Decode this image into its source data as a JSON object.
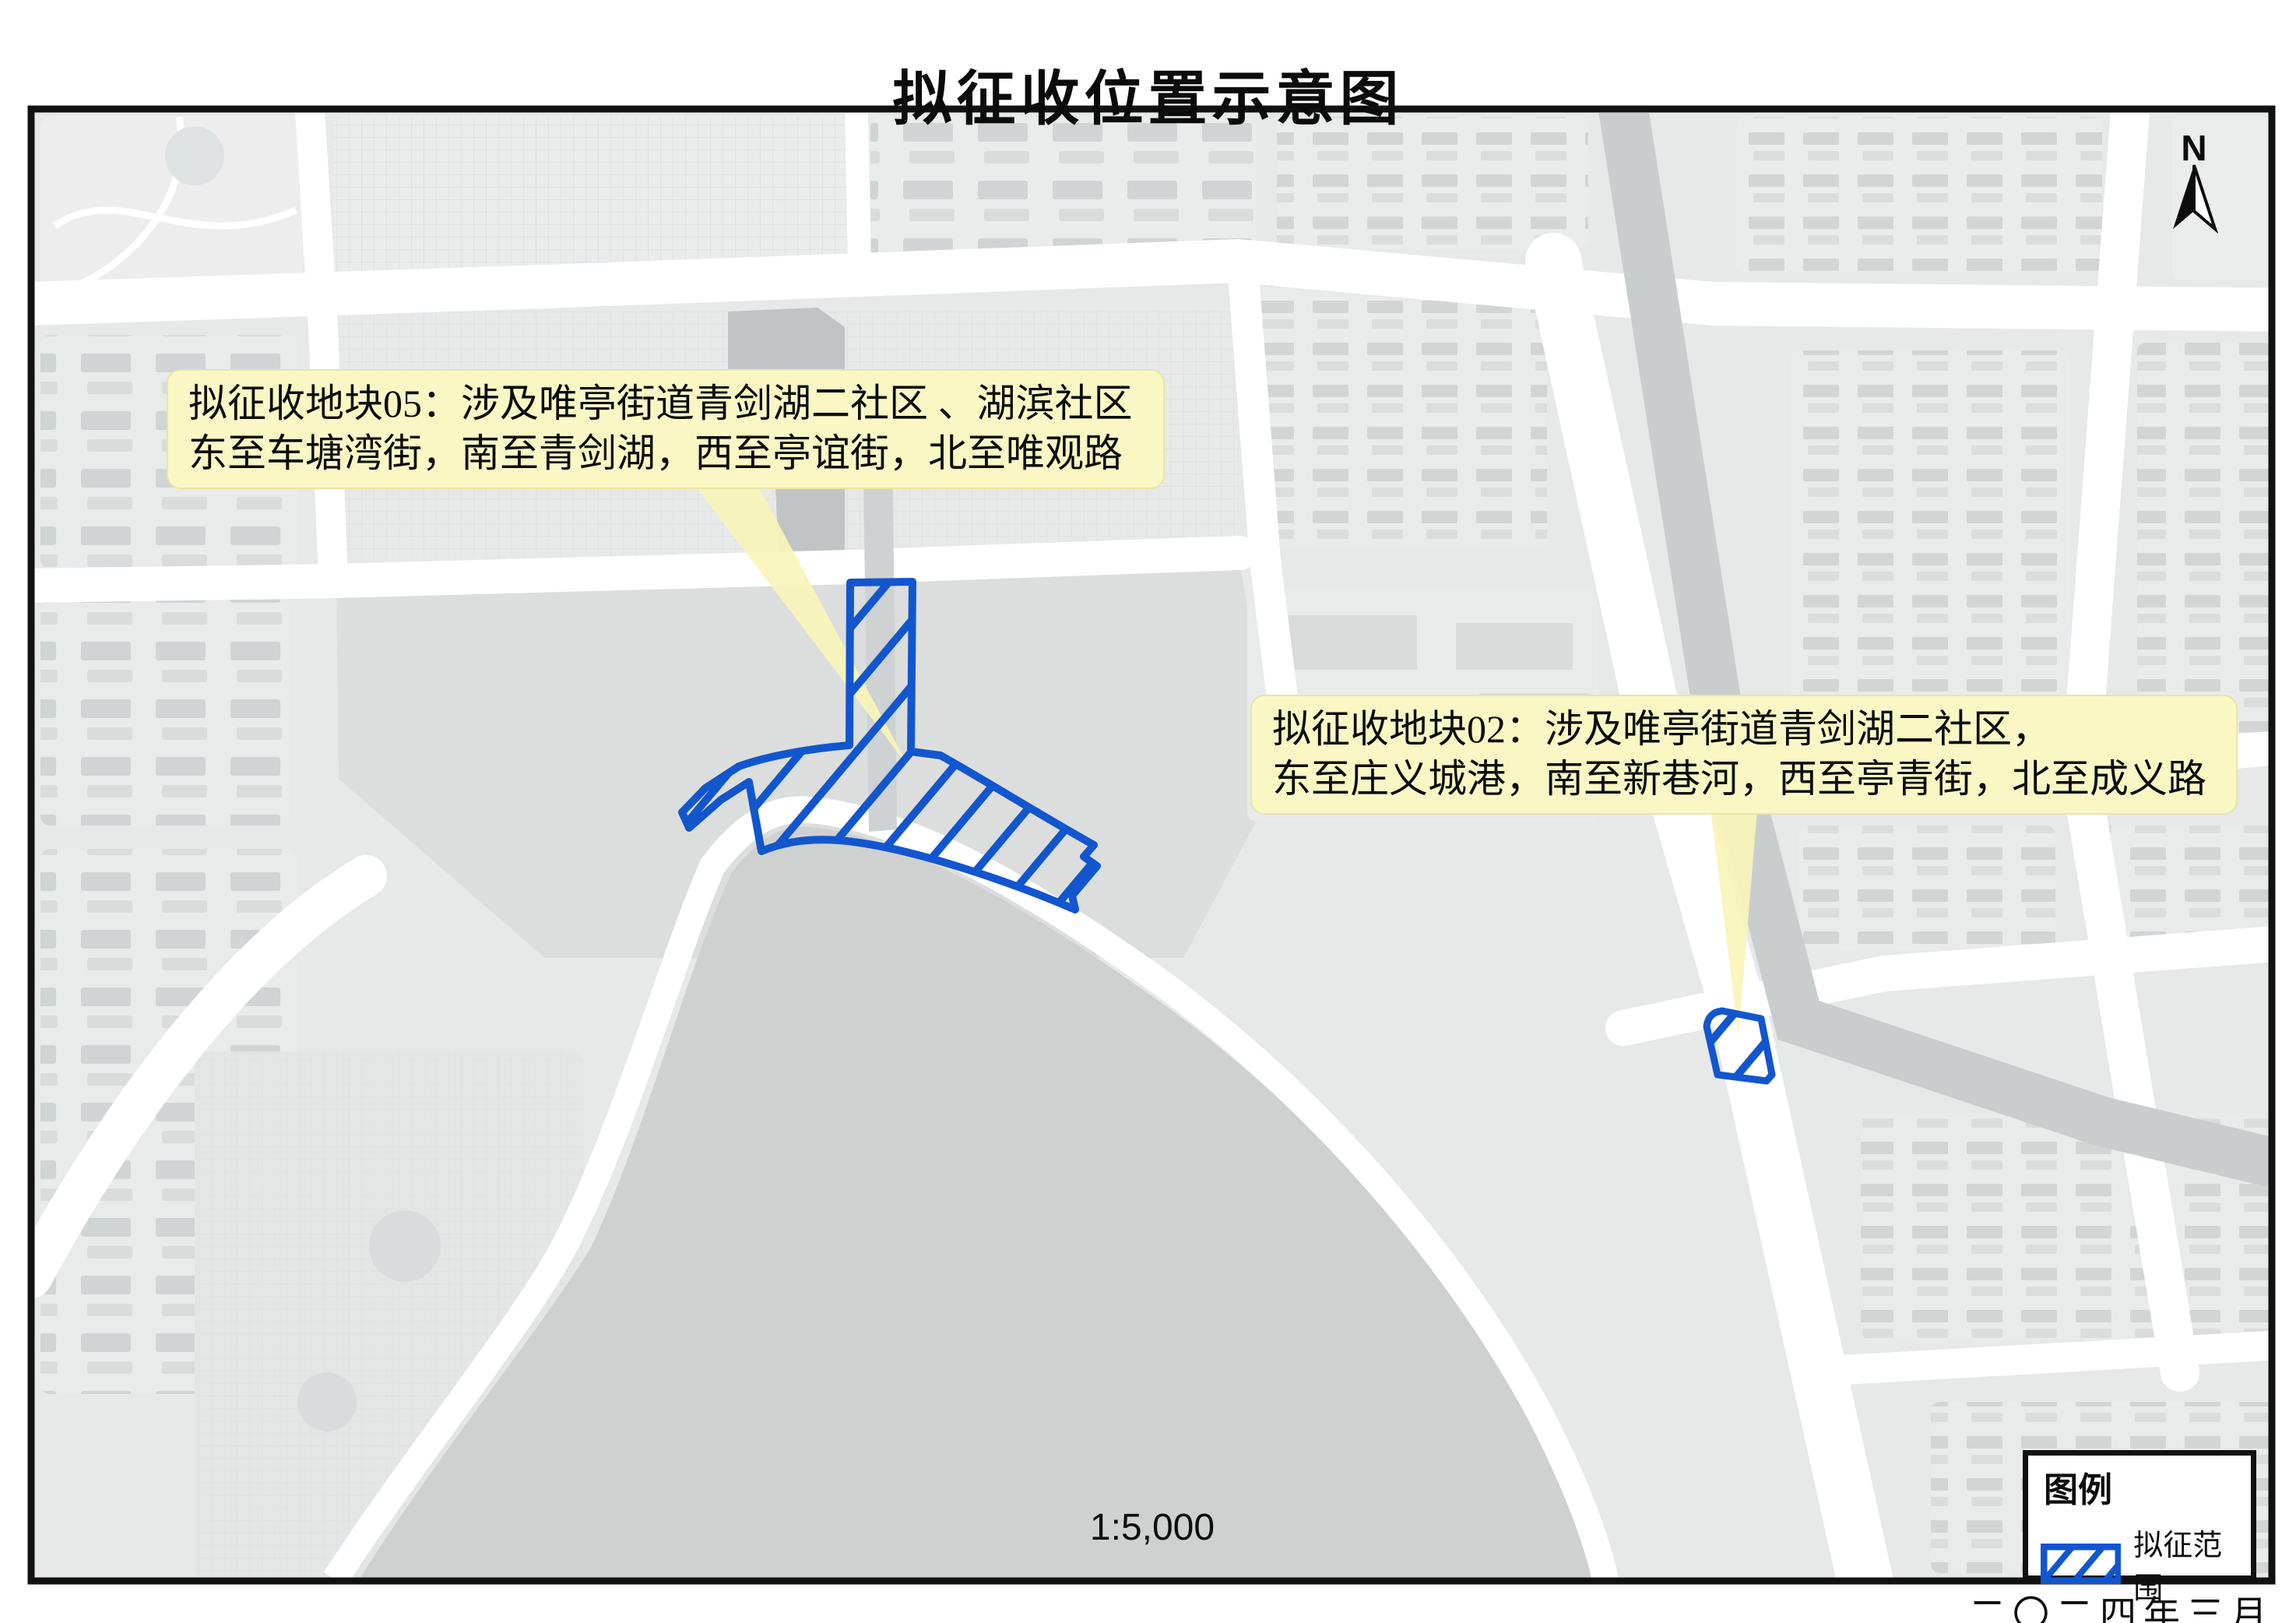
{
  "title": "拟征收位置示意图",
  "map": {
    "north_label": "N",
    "scale_label": "1:5,000",
    "date_label": "二〇二四年三月"
  },
  "callouts": [
    {
      "parcel": "05",
      "line1": "拟征收地块05：涉及唯亭街道青剑湖二社区 、湖滨社区",
      "line2": "东至车塘湾街，南至青剑湖，西至亭谊街，北至唯观路"
    },
    {
      "parcel": "02",
      "line1": "拟征收地块02：涉及唯亭街道青剑湖二社区，",
      "line2": "东至庄义城港，南至新巷河，西至亭青街，北至成义路"
    }
  ],
  "legend": {
    "title": "图例",
    "items": [
      {
        "symbol": "blue-diagonal-hatch",
        "label": "拟征范围"
      }
    ]
  },
  "colors": {
    "parcel_outline": "#1256cf",
    "callout_bg": "#f9f8c5",
    "leader_fill": "#f7f4b9",
    "lake": "#cfd1d1",
    "river": "#c9cdce",
    "road": "#ffffff",
    "block": "#e9eaea",
    "open_land": "#dcdedd",
    "frame": "#111111"
  }
}
